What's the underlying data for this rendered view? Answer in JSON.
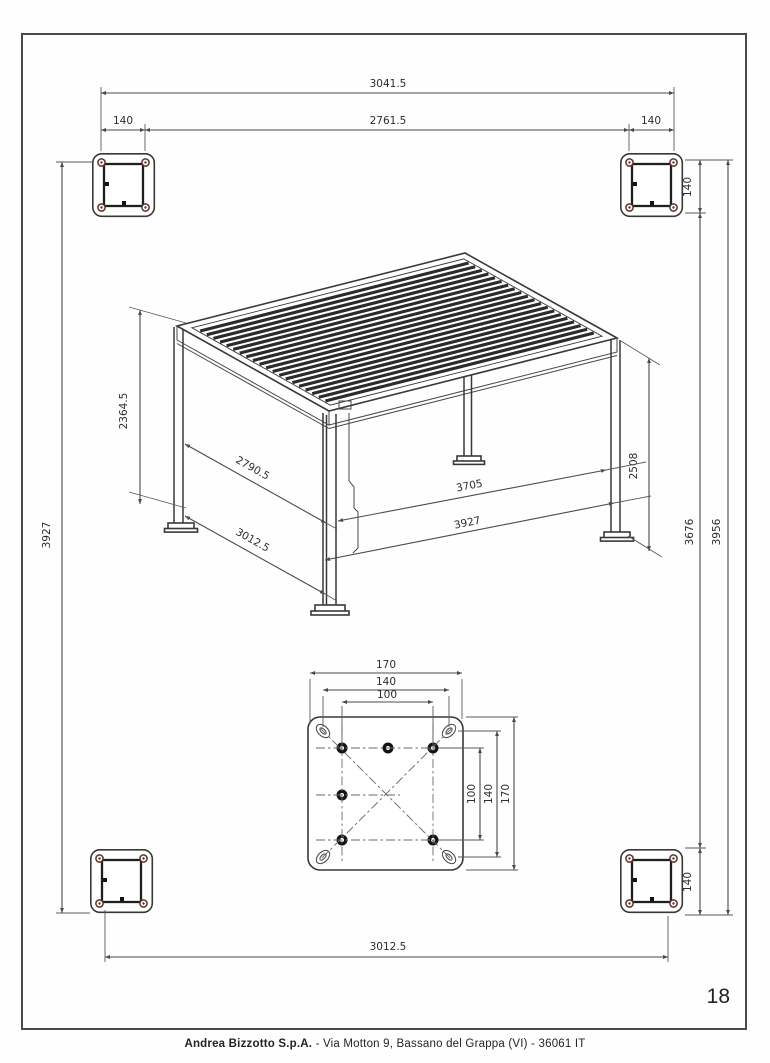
{
  "page": {
    "number": "18"
  },
  "footer": {
    "company": "Andrea Bizzotto S.p.A.",
    "address": " - Via Motton 9, Bassano del Grappa (VI) - 36061 IT"
  },
  "dims": {
    "top_overall": "3041.5",
    "top_inner": "2761.5",
    "top_offset_left": "140",
    "top_offset_right": "140",
    "left_span": "3927",
    "side_offset_top": "140",
    "side_inner": "3676",
    "side_overall": "3956",
    "side_offset_bottom": "140",
    "rear_post_height": "2364.5",
    "front_post_height": "2508",
    "depth_inner": "2790.5",
    "depth_outer": "3012.5",
    "width_inner": "3705",
    "width_outer": "3927",
    "bottom_span": "3012.5",
    "plate_top_outer": "170",
    "plate_top_mid": "140",
    "plate_top_inner": "100",
    "plate_side_inner": "100",
    "plate_side_mid": "140",
    "plate_side_outer": "170"
  }
}
